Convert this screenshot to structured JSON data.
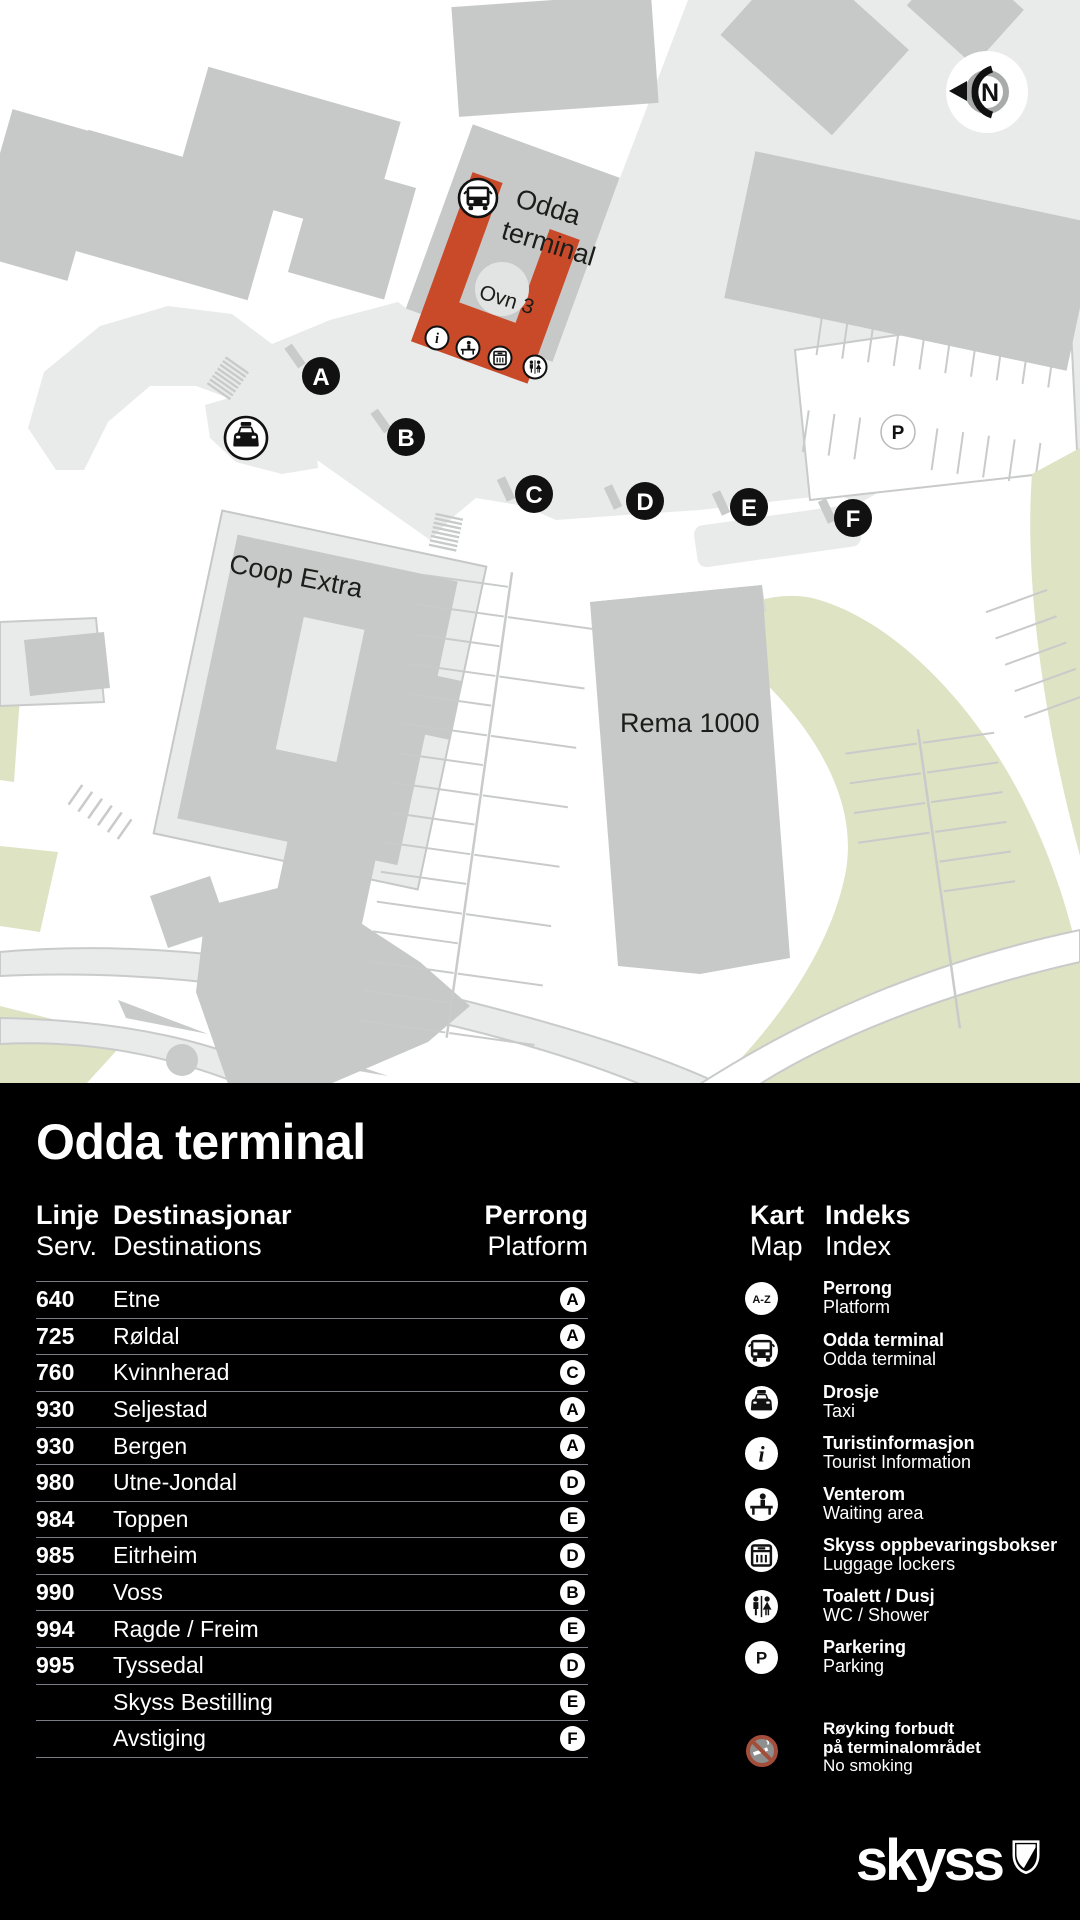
{
  "map": {
    "labels": {
      "terminal_line1": "Odda",
      "terminal_line2": "terminal",
      "ovn": "Ovn 3",
      "coop": "Coop Extra",
      "rema": "Rema 1000",
      "north": "N",
      "parking_badge": "P"
    },
    "platforms": [
      {
        "letter": "A"
      },
      {
        "letter": "B"
      },
      {
        "letter": "C"
      },
      {
        "letter": "D"
      },
      {
        "letter": "E"
      },
      {
        "letter": "F"
      }
    ]
  },
  "panel": {
    "title": "Odda terminal",
    "columns": {
      "line_no": "Linje",
      "line_en": "Serv.",
      "dest_no": "Destinasjonar",
      "dest_en": "Destinations",
      "platform_no": "Perrong",
      "platform_en": "Platform"
    },
    "index_header": {
      "kart": "Kart",
      "map": "Map",
      "indeks": "Indeks",
      "index": "Index"
    },
    "rows": [
      {
        "line": "640",
        "destination": "Etne",
        "platform": "A"
      },
      {
        "line": "725",
        "destination": "Røldal",
        "platform": "A"
      },
      {
        "line": "760",
        "destination": "Kvinnherad",
        "platform": "C"
      },
      {
        "line": "930",
        "destination": "Seljestad",
        "platform": "A"
      },
      {
        "line": "930",
        "destination": "Bergen",
        "platform": "A"
      },
      {
        "line": "980",
        "destination": "Utne-Jondal",
        "platform": "D"
      },
      {
        "line": "984",
        "destination": "Toppen",
        "platform": "E"
      },
      {
        "line": "985",
        "destination": "Eitrheim",
        "platform": "D"
      },
      {
        "line": "990",
        "destination": "Voss",
        "platform": "B"
      },
      {
        "line": "994",
        "destination": "Ragde / Freim",
        "platform": "E"
      },
      {
        "line": "995",
        "destination": "Tyssedal",
        "platform": "D"
      },
      {
        "line": "",
        "destination": "Skyss Bestilling",
        "platform": "E"
      },
      {
        "line": "",
        "destination": "Avstiging",
        "platform": "F"
      }
    ],
    "legend": [
      {
        "icon": "az-icon",
        "label_az": "A-Z",
        "no": "Perrong",
        "en": "Platform"
      },
      {
        "icon": "bus-icon",
        "no": "Odda terminal",
        "en": "Odda terminal"
      },
      {
        "icon": "taxi-icon",
        "no": "Drosje",
        "en": "Taxi"
      },
      {
        "icon": "info-icon",
        "no": "Turistinformasjon",
        "en": "Tourist Information"
      },
      {
        "icon": "waiting-icon",
        "no": "Venterom",
        "en": "Waiting area"
      },
      {
        "icon": "locker-icon",
        "no": "Skyss oppbevaringsbokser",
        "en": "Luggage lockers"
      },
      {
        "icon": "wc-icon",
        "no": "Toalett / Dusj",
        "en": "WC / Shower"
      },
      {
        "icon": "parking-icon",
        "label_p": "P",
        "no": "Parkering",
        "en": "Parking"
      }
    ],
    "no_smoking": {
      "no_line1": "Røyking forbudt",
      "no_line2": "på terminalområdet",
      "en": "No smoking"
    },
    "logo_text": "skyss"
  },
  "colors": {
    "accent_red": "#c94a29",
    "building_gray": "#c7c8c8",
    "plaza_gray": "#e9eaea",
    "green_area": "#dde3c3",
    "panel_bg": "#000000"
  }
}
